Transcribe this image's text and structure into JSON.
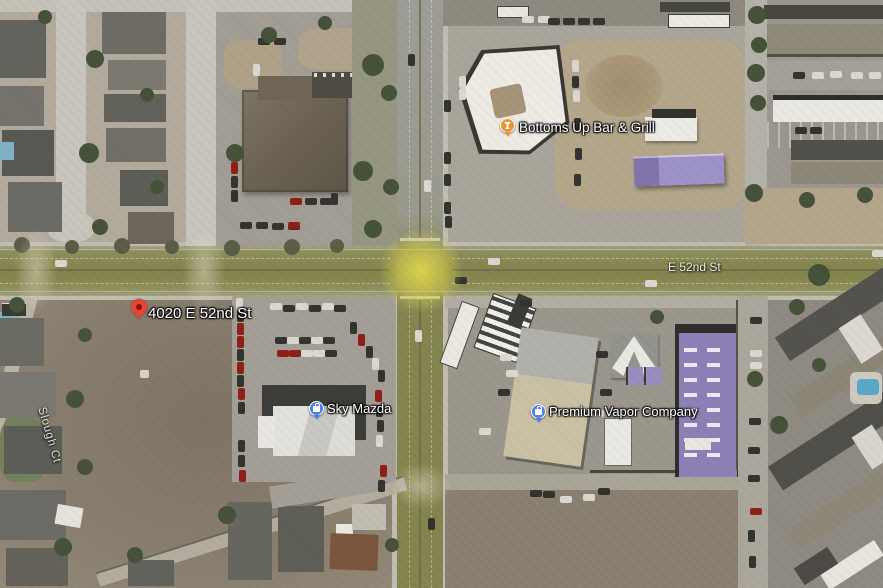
{
  "map": {
    "view_type": "satellite",
    "road_labels": [
      {
        "text": "E 52nd St",
        "orientation": "horizontal"
      },
      {
        "text": "Slough Ct",
        "orientation": "diagonal"
      }
    ],
    "pois": [
      {
        "label": "Bottoms Up Bar & Grill",
        "category_pin": "bar-grill",
        "pin_color": "#ea9430"
      },
      {
        "label": "Sky Mazda",
        "category_pin": "shopping",
        "pin_color": "#4f7fe8"
      },
      {
        "label": "Premium Vapor Company",
        "category_pin": "shopping",
        "pin_color": "#4f7fe8"
      }
    ],
    "address_marker": {
      "label": "4020 E 52nd St",
      "pin_color": "#e94335"
    },
    "highlight_colors": {
      "road": "#85854f",
      "intersection_glow": "#e9e049"
    }
  }
}
